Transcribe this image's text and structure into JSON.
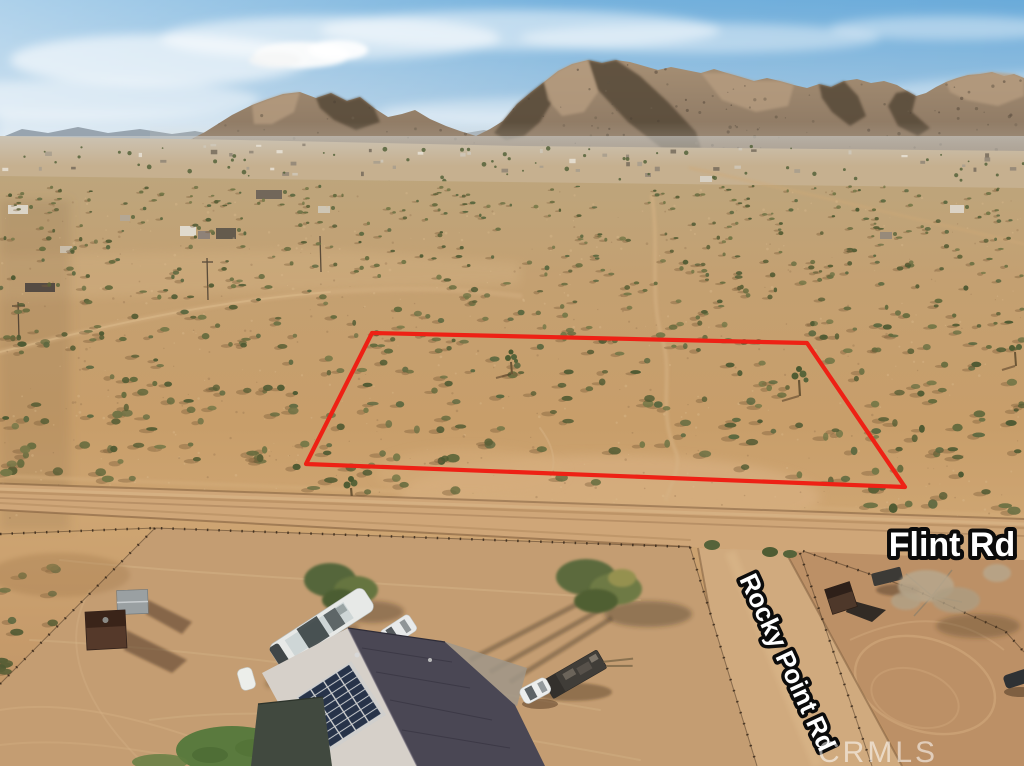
{
  "scene": {
    "type": "aerial-drone-photo",
    "description": "Aerial drone photo of a vacant desert land parcel outlined in red at Flint Rd and Rocky Point Rd, desert mountains on the horizon, solar-roofed home and fenced dirt yards in the foreground",
    "width_px": 1024,
    "height_px": 766
  },
  "road_labels": {
    "flint": "Flint Rd",
    "rocky_point": "Rocky Point Rd"
  },
  "watermark": {
    "text": "CRMLS"
  },
  "property_boundary": {
    "color": "#ee2115",
    "stroke_width": 4.2,
    "points": "372,333 807,343 905,487 306,464"
  },
  "palette": {
    "sky_top": "#66a9d8",
    "sky_haze": "#d7e2ea",
    "cloud": "#f4f6f7",
    "mountain": "#917c66",
    "mountain_shadow": "#564838",
    "mountain_lit": "#b89e81",
    "valley": "#c6b08f",
    "desert_sand": "#c59e6c",
    "road_dirt": "#cfa678",
    "shrub_green": "#5a5f36",
    "boundary_red": "#ee2115",
    "roof_dark": "#4a4754",
    "roof_light": "#d6d0c9",
    "solar_panel": "#1f2b42",
    "lawn_green": "#5a7a3e",
    "label_fill": "#ffffff",
    "label_outline": "#0b0b0b"
  }
}
